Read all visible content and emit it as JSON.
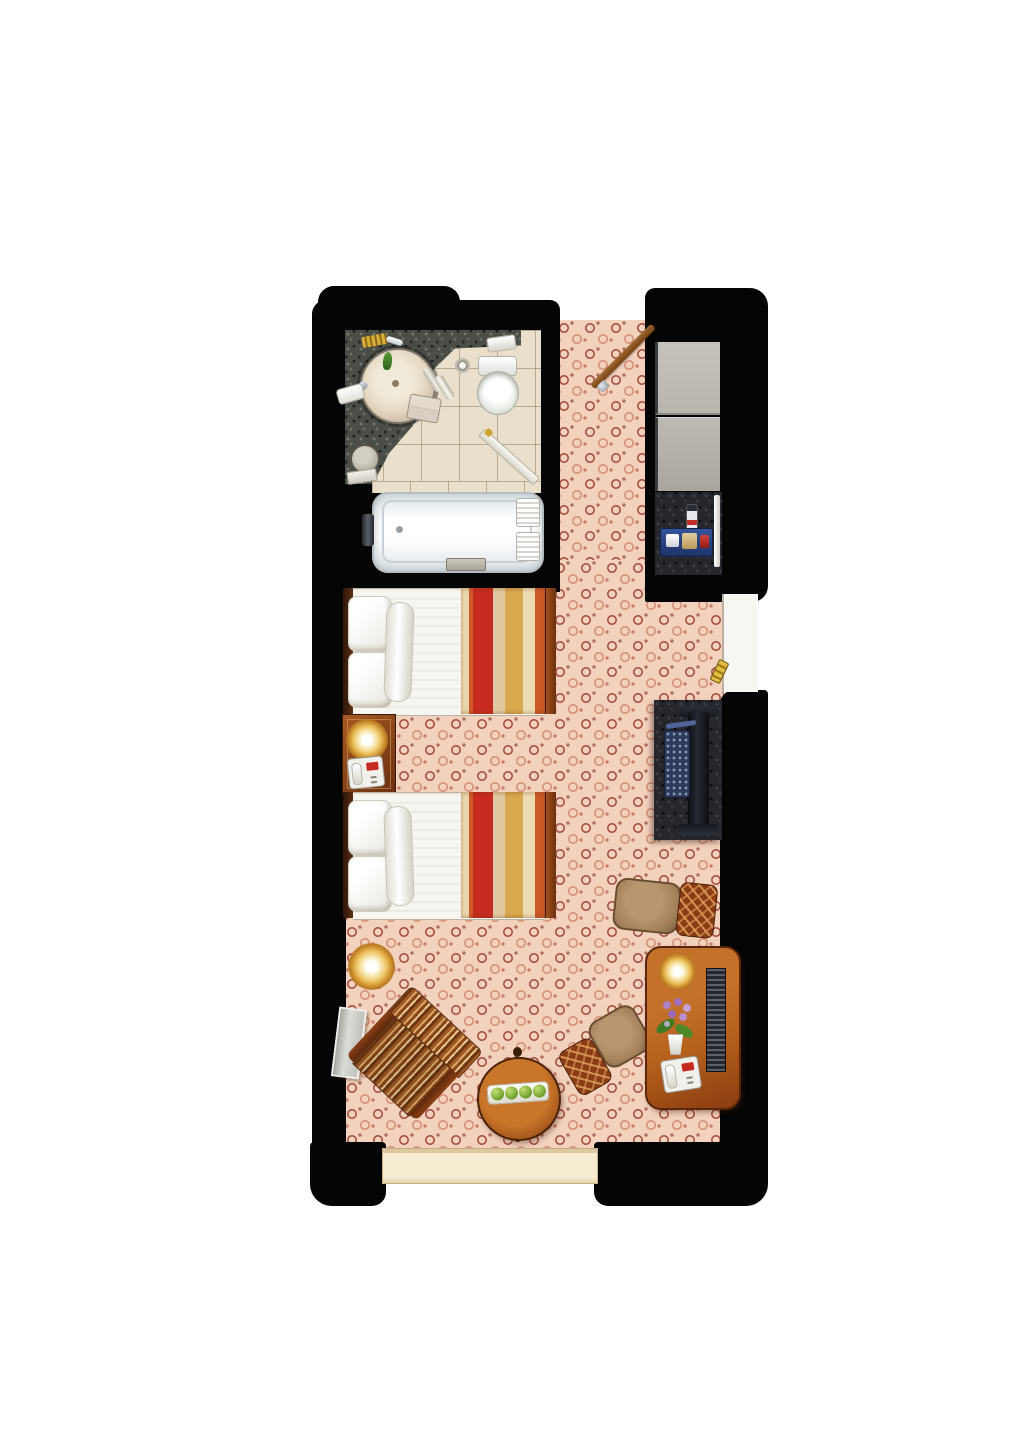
{
  "title": "hotel-guestroom-floor-plan",
  "palette": {
    "wall": "#050505",
    "carpet_base": "#f3d2bd",
    "carpet_swirl": "#8e2a22",
    "tile": "#eadfca",
    "granite": "#4a4e46",
    "granite_dark": "#25272c",
    "linen": "#f7f5ef",
    "runner_red": "#c62a20",
    "runner_gold": "#d8a84e",
    "runner_orange": "#cc5a28",
    "closet_gray": "#b8b5ae",
    "lamp_gold": "#eec564",
    "sill_cream": "#f6ecd2",
    "tan_seat": "#a5825c",
    "chair_wood": "#8a3c14",
    "desk_wood": "#b6611c",
    "tv_black": "#16181e",
    "keyboard_blue": "#2e3c5c",
    "apple_green": "#7aa832",
    "orchid_purple": "#b080c8",
    "door_wood": "#a06a30",
    "niche_white": "#f7f6f3"
  },
  "names": {
    "plan": "hotel guestroom floor plan (top-down)",
    "bathroom": "bathroom with vanity, sink, toilet and tiled floor",
    "vanity": "granite vanity counter",
    "sink": "round basin sink",
    "toilet": "toilet",
    "bathtub": "bathtub",
    "bathroom_door": "bathroom door swing",
    "entry": "entry hallway carpet",
    "entry_door": "entry door (open swing)",
    "closet": "closet with sliding doors",
    "minibar": "minibar counter with tray and bottle",
    "connecting_door": "connecting-room door niche",
    "bed1": "twin bed 1 with striped runner",
    "bed2": "twin bed 2 with striped runner",
    "nightstand": "nightstand with lamp and telephone",
    "tv_console": "granite TV console with television and keyboard",
    "chair1": "side chair",
    "chair2": "desk chair",
    "desk": "writing desk with lamp, orchid and telephone",
    "louver": "louvered bench panel",
    "floor_lamp": "floor lamp",
    "lounge_chair": "striped lounge chair",
    "leaning_board": "leaning board against wall",
    "coffee_table": "round coffee table",
    "apple_tray": "tray with green apples",
    "window": "window sill",
    "key": "gold door key"
  },
  "rooms": [
    {
      "id": "bathroom",
      "fixtures": [
        "vanity-counter",
        "round-sink",
        "toilet",
        "toilet-paper",
        "amenities",
        "rolled-towels",
        "folded-towels",
        "bathrobe",
        "waste-bin",
        "bath-mat",
        "bathtub",
        "tub-faucet",
        "tub-towels",
        "door-swing"
      ]
    },
    {
      "id": "entry-hall",
      "fixtures": [
        "entry-door",
        "patterned-carpet"
      ]
    },
    {
      "id": "closet-nook",
      "fixtures": [
        "sliding-doors",
        "minibar-counter",
        "service-tray",
        "bottle",
        "minibar-door"
      ]
    },
    {
      "id": "guest-room",
      "fixtures": [
        "twin-bed-1",
        "twin-bed-2",
        "nightstand",
        "nightstand-lamp",
        "nightstand-phone",
        "tv-console",
        "television",
        "keyboard",
        "side-chair",
        "desk-chair",
        "desk",
        "desk-lamp",
        "orchid-plant",
        "desk-phone",
        "louvered-bench",
        "floor-lamp",
        "lounge-chair",
        "leaning-board",
        "coffee-table",
        "apple-tray",
        "window",
        "connecting-door",
        "gold-key"
      ]
    }
  ]
}
